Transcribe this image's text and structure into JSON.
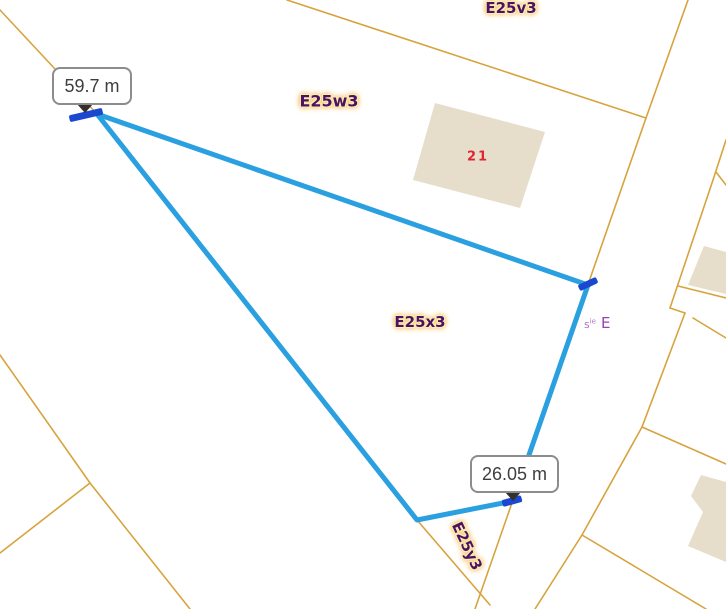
{
  "map": {
    "region_labels": [
      {
        "id": "e25v3",
        "text": "E25v3"
      },
      {
        "id": "e25w3",
        "text": "E25w3"
      },
      {
        "id": "e25x3",
        "text": "E25x3"
      },
      {
        "id": "e25y3",
        "text": "E25y3"
      }
    ],
    "building_label": "21",
    "section_label": {
      "prefix": "s",
      "superscript": "ie",
      "section": "E"
    }
  },
  "measurement": {
    "tooltips": [
      {
        "text": "59.7 m"
      },
      {
        "text": "26.05 m"
      }
    ]
  },
  "colors": {
    "parcel_line": "#d8a33e",
    "building_fill": "#e6decb",
    "measure_line": "#2aa0e0",
    "vertex_tick": "#1b47d1",
    "region_label_text": "#4b1263",
    "label_halo": "#fcecb0",
    "building_number": "#e0242f",
    "section_label": "#9a41b8",
    "tooltip_border": "#8c8c8c",
    "tooltip_text": "#3e3e3e",
    "tooltip_arrow": "#35312a"
  }
}
